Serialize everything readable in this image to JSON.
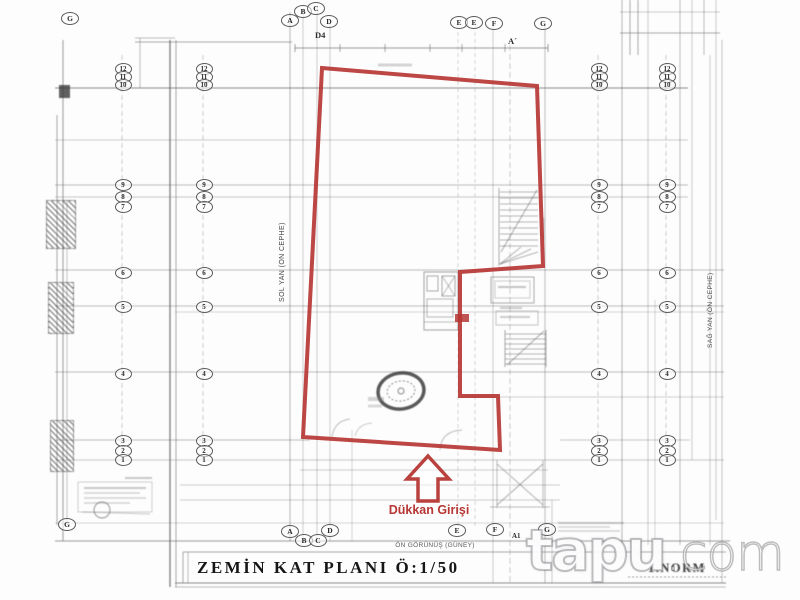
{
  "title": {
    "text": "ZEMİN KAT PLANI Ö:1/50"
  },
  "footer": {
    "norm": "1.NORM"
  },
  "entrance": {
    "label": "Dükkan Girişi"
  },
  "side_labels": {
    "front": "ÖN GÖRÜNÜŞ (GÜNEY)",
    "left": "SOL YAN (ÖN CEPHE)",
    "right": "SAĞ YAN (ÖN CEPHE)"
  },
  "marks": {
    "d4": "D4",
    "section": "A´",
    "a1": "A1"
  },
  "watermark": {
    "brand": "tapu",
    "suffix": ".com"
  },
  "colors": {
    "red": "#b63734",
    "line": "#5a5a5a"
  },
  "grid": {
    "top_letters": [
      {
        "l": "G",
        "x": 69,
        "y": 17
      },
      {
        "l": "A",
        "x": 289,
        "y": 19
      },
      {
        "l": "B",
        "x": 302,
        "y": 10
      },
      {
        "l": "C",
        "x": 315,
        "y": 7
      },
      {
        "l": "D",
        "x": 328,
        "y": 20
      },
      {
        "l": "E",
        "x": 458,
        "y": 21
      },
      {
        "l": "E",
        "x": 473,
        "y": 21
      },
      {
        "l": "F",
        "x": 493,
        "y": 22
      },
      {
        "l": "G",
        "x": 542,
        "y": 22
      }
    ],
    "bottom_letters": [
      {
        "l": "G",
        "x": 66,
        "y": 523
      },
      {
        "l": "A",
        "x": 289,
        "y": 530
      },
      {
        "l": "B",
        "x": 303,
        "y": 539
      },
      {
        "l": "C",
        "x": 317,
        "y": 539
      },
      {
        "l": "D",
        "x": 329,
        "y": 529
      },
      {
        "l": "E",
        "x": 456,
        "y": 529
      },
      {
        "l": "F",
        "x": 494,
        "y": 528
      },
      {
        "l": "G",
        "x": 546,
        "y": 528
      }
    ],
    "number_columns": [
      122,
      203,
      598,
      666
    ],
    "number_rows": [
      {
        "v": "12",
        "y": 68
      },
      {
        "v": "11",
        "y": 76
      },
      {
        "v": "10",
        "y": 84
      },
      {
        "v": "9",
        "y": 184
      },
      {
        "v": "8",
        "y": 196
      },
      {
        "v": "7",
        "y": 206
      },
      {
        "v": "6",
        "y": 272
      },
      {
        "v": "5",
        "y": 306
      },
      {
        "v": "4",
        "y": 373
      },
      {
        "v": "3",
        "y": 440
      },
      {
        "v": "2",
        "y": 450
      },
      {
        "v": "1",
        "y": 459
      }
    ]
  }
}
